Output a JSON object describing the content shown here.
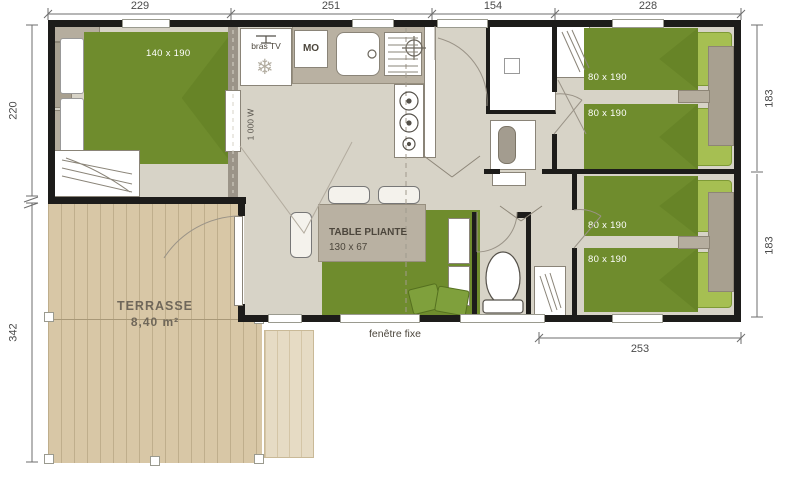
{
  "colors": {
    "wall": "#1d1c1a",
    "floor": "#d7d3c7",
    "bed_green": "#6f8c2d",
    "pillow_green": "#a6bf52",
    "fold_green": "#5d7a21",
    "furniture_taupe": "#b9b1a2",
    "furniture_gray": "#a8a090",
    "deck": "#d8c7a6",
    "deck_light": "#e6dbc4",
    "deck_line": "#bfae8c",
    "dim": "#4a4a4a"
  },
  "plan": {
    "dims": {
      "top": [
        "229",
        "251",
        "154",
        "228"
      ],
      "left": [
        "220",
        "342"
      ],
      "right": [
        "183",
        "183"
      ],
      "bottom": [
        "253"
      ]
    },
    "master_bedroom": {
      "bed": "140 x 190"
    },
    "kitchen": {
      "tv_bracket": "bras TV",
      "snowflake": "❄",
      "microwave": "MO"
    },
    "living": {
      "radiator": "1 000 W",
      "table_name": "TABLE PLIANTE",
      "table_size": "130 x 67",
      "window": "fenêtre fixe"
    },
    "bedroom_top": {
      "bed_a": "80 x 190",
      "bed_b": "80 x 190"
    },
    "bedroom_bottom": {
      "bed_a": "80 x 190",
      "bed_b": "80 x 190"
    },
    "terrace": {
      "name": "TERRASSE",
      "area": "8,40 m²"
    }
  }
}
